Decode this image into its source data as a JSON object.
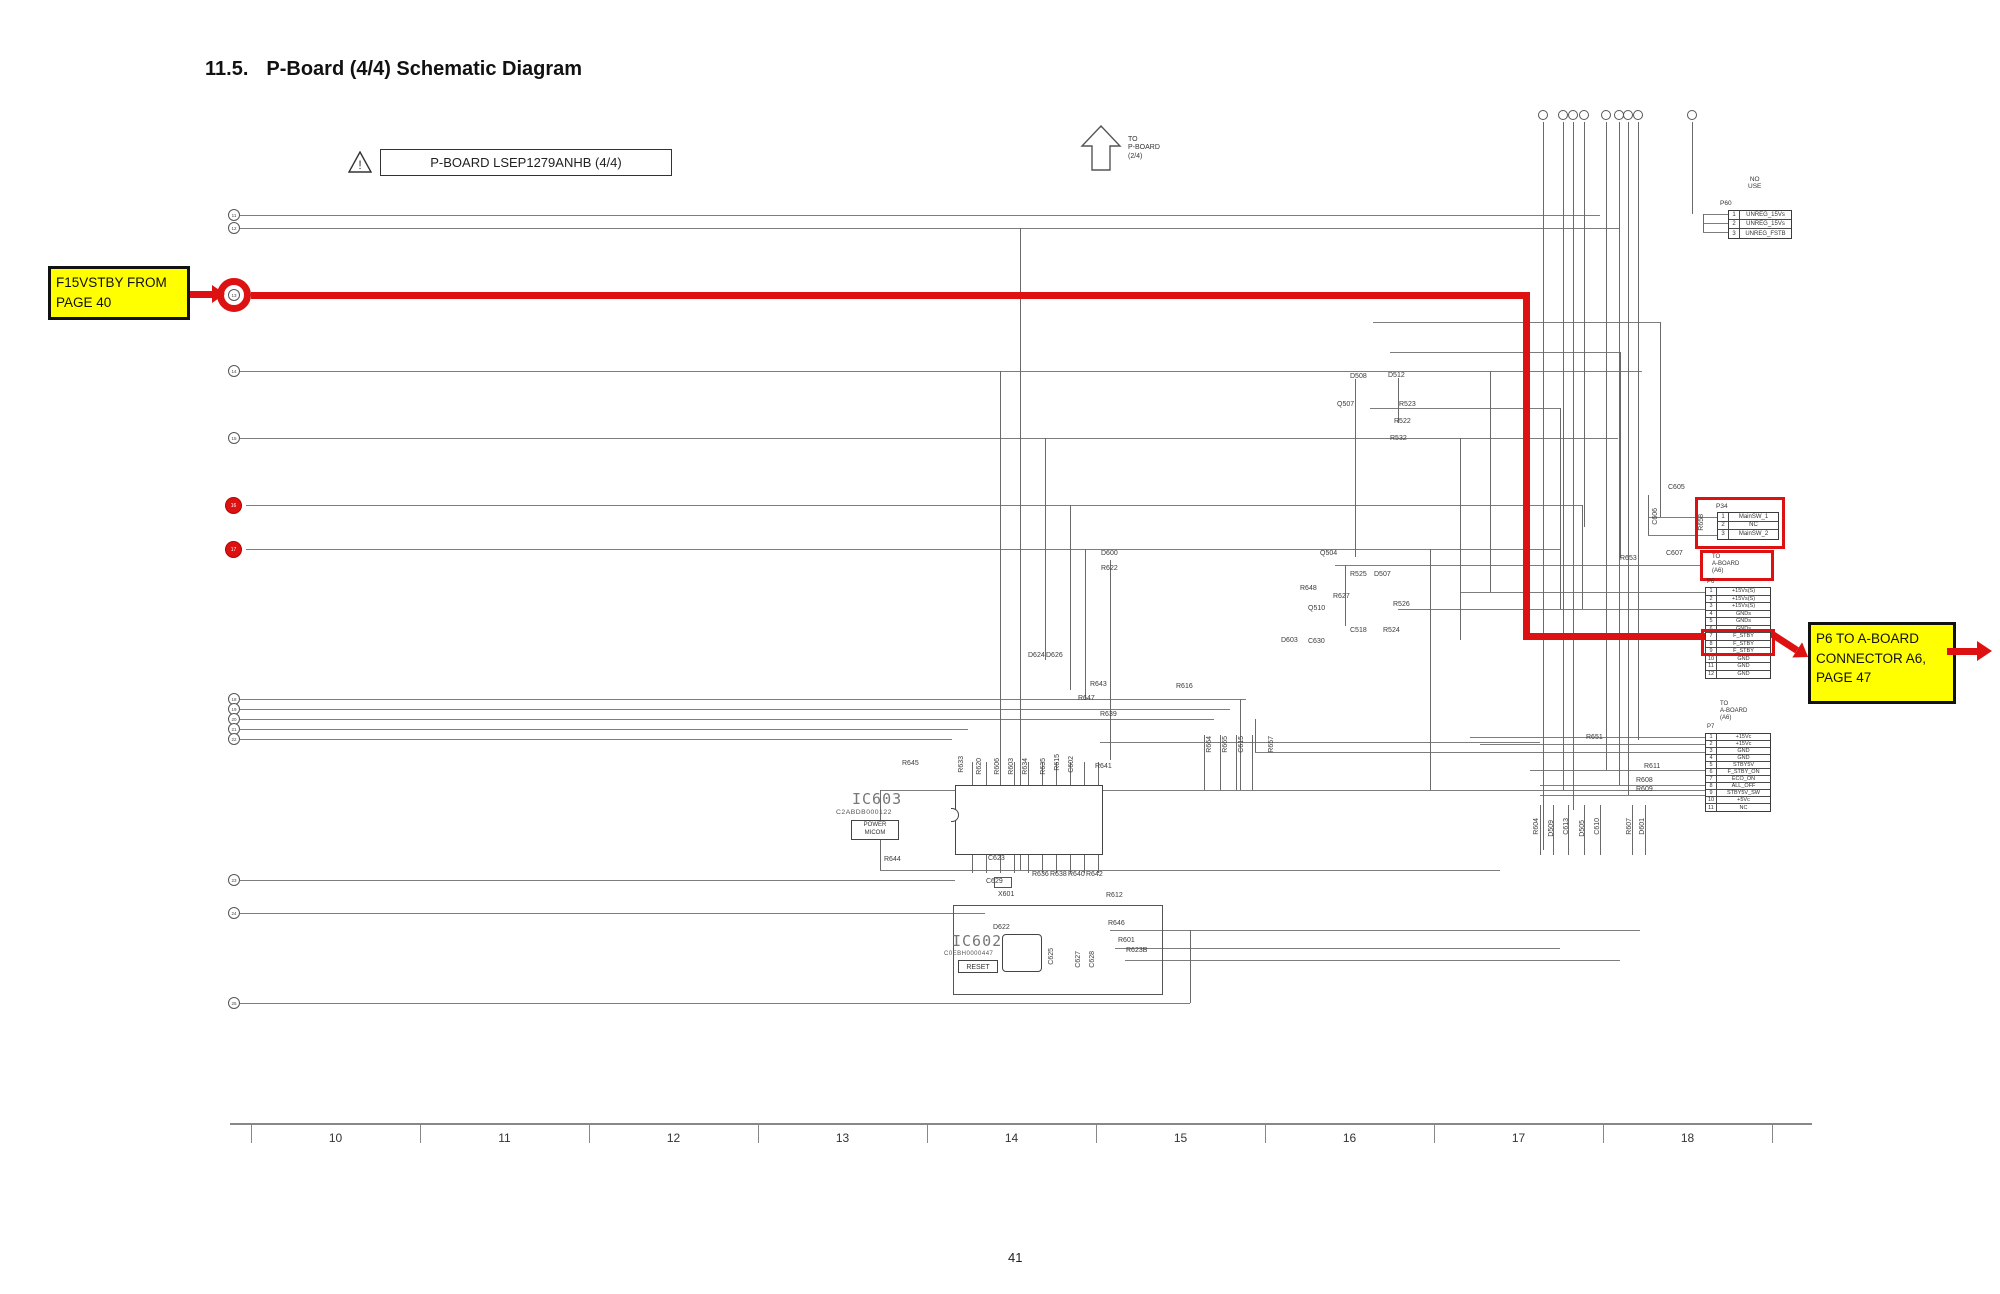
{
  "page": {
    "section_number": "11.5.",
    "section_title": "P-Board (4/4) Schematic Diagram",
    "page_number": "41"
  },
  "board_label": {
    "text": "P-BOARD LSEP1279ANHB (4/4)"
  },
  "to_pboard": {
    "line1": "TO",
    "line2": "P-BOARD",
    "line3": "(2/4)"
  },
  "callout_left": {
    "line1": "F15VSTBY FROM",
    "line2": "PAGE 40"
  },
  "callout_right": {
    "line1": "P6 TO A-BOARD",
    "line2": "CONNECTOR A6,",
    "line3": "PAGE 47"
  },
  "no_use": {
    "line1": "NO",
    "line2": "USE"
  },
  "colors": {
    "highlight_red": "#dd1111",
    "callout_yellow": "#ffff00",
    "wire_gray": "#7d7d7d"
  },
  "connectors": {
    "p60": {
      "name": "P60",
      "rows": [
        [
          "1",
          "UNREG_15Vs"
        ],
        [
          "2",
          "UNREG_15Vs"
        ],
        [
          "3",
          "UNREG_FSTB"
        ]
      ]
    },
    "p34": {
      "name": "P34",
      "rows": [
        [
          "1",
          "MainSW_1"
        ],
        [
          "2",
          "NC"
        ],
        [
          "3",
          "MainSW_2"
        ]
      ]
    },
    "p6": {
      "name": "P6",
      "dest_line1": "TO",
      "dest_line2": "A-BOARD",
      "dest_line3": "(A6)",
      "rows": [
        [
          "1",
          "+15Vs(S)"
        ],
        [
          "2",
          "+15Vs(S)"
        ],
        [
          "3",
          "+15Vs(S)"
        ],
        [
          "4",
          "GNDs"
        ],
        [
          "5",
          "GNDs"
        ],
        [
          "6",
          "GNDs"
        ],
        [
          "7",
          "F_STBY"
        ],
        [
          "8",
          "F_STBY"
        ],
        [
          "9",
          "F_STBY"
        ],
        [
          "10",
          "GND"
        ],
        [
          "11",
          "GND"
        ],
        [
          "12",
          "GND"
        ]
      ],
      "highlighted_rows": [
        "7",
        "8",
        "9"
      ]
    },
    "p7": {
      "name": "P7",
      "dest_line1": "TO",
      "dest_line2": "A-BOARD",
      "dest_line3": "(A6)",
      "rows": [
        [
          "1",
          "+15Vc"
        ],
        [
          "2",
          "+15Vc"
        ],
        [
          "3",
          "GND"
        ],
        [
          "4",
          "GND"
        ],
        [
          "5",
          "STBY5V"
        ],
        [
          "6",
          "F_STBY_ON"
        ],
        [
          "7",
          "ECO_ON"
        ],
        [
          "8",
          "ALL_OFF"
        ],
        [
          "9",
          "STBY5V_SW"
        ],
        [
          "10",
          "+5Vc"
        ],
        [
          "11",
          "NC"
        ]
      ]
    }
  },
  "ics": {
    "ic603": {
      "ref": "IC603",
      "part": "C2ABDB000122",
      "function_line1": "POWER",
      "function_line2": "MICOM",
      "top_pin_numbers": [
        "20",
        "19",
        "18",
        "17",
        "16",
        "15",
        "14",
        "13",
        "12",
        "11"
      ],
      "bottom_pin_numbers": [
        "1",
        "2",
        "3",
        "4",
        "5",
        "6",
        "7",
        "8",
        "9",
        "10"
      ],
      "top_pin_labels": [
        "AC_DET_L",
        "AC_FAIL_H",
        "P_RLY_ON_H",
        "N_RLY_ON_H",
        "F15_ON_H",
        "SOS4_H",
        "PFC_ON_L",
        "STB5_GD_H",
        "VF150_ON_L",
        "ALL_OFF_P"
      ],
      "bottom_pin_labels": [
        "VDD",
        "VSS",
        "Xin",
        "Xout",
        "CNVss",
        "RST_L",
        "M_SW_ON_H",
        "STB5_ON_L",
        "F-STB_ON_H",
        "PANEL_ON_L"
      ]
    },
    "ic602": {
      "ref": "IC602",
      "part": "C0EBH0000447",
      "function": "RESET",
      "pin_numbers_top": [
        "3",
        "2",
        "1"
      ],
      "pin_numbers_bottom": [
        "4",
        "5"
      ],
      "crystal": "X601"
    }
  },
  "ruler": {
    "labels": [
      "10",
      "11",
      "12",
      "13",
      "14",
      "15",
      "16",
      "17",
      "18"
    ]
  },
  "left_refs": [
    {
      "n": "11",
      "y": 215,
      "style": "plain"
    },
    {
      "n": "12",
      "y": 228,
      "style": "plain"
    },
    {
      "n": "13",
      "y": 295,
      "style": "red-ring"
    },
    {
      "n": "14",
      "y": 371,
      "style": "plain"
    },
    {
      "n": "15",
      "y": 438,
      "style": "plain"
    },
    {
      "n": "16",
      "y": 505,
      "style": "red-dot"
    },
    {
      "n": "17",
      "y": 549,
      "style": "red-dot"
    },
    {
      "n": "18",
      "y": 699,
      "style": "plain"
    },
    {
      "n": "19",
      "y": 709,
      "style": "plain"
    },
    {
      "n": "20",
      "y": 719,
      "style": "plain"
    },
    {
      "n": "21",
      "y": 729,
      "style": "plain"
    },
    {
      "n": "22",
      "y": 739,
      "style": "plain"
    },
    {
      "n": "23",
      "y": 880,
      "style": "plain"
    },
    {
      "n": "24",
      "y": 913,
      "style": "plain"
    },
    {
      "n": "25",
      "y": 1003,
      "style": "plain"
    }
  ],
  "components": [
    {
      "l": "R645",
      "x": 902,
      "y": 760,
      "r": 0
    },
    {
      "l": "R633",
      "x": 958,
      "y": 756,
      "r": 1
    },
    {
      "l": "R620",
      "x": 976,
      "y": 758,
      "r": 1
    },
    {
      "l": "R606",
      "x": 994,
      "y": 758,
      "r": 1
    },
    {
      "l": "R603",
      "x": 1008,
      "y": 758,
      "r": 1
    },
    {
      "l": "R634",
      "x": 1022,
      "y": 758,
      "r": 1
    },
    {
      "l": "R635",
      "x": 1040,
      "y": 758,
      "r": 1
    },
    {
      "l": "R615",
      "x": 1054,
      "y": 754,
      "r": 1
    },
    {
      "l": "C602",
      "x": 1068,
      "y": 756,
      "r": 1
    },
    {
      "l": "R641",
      "x": 1095,
      "y": 763,
      "r": 0
    },
    {
      "l": "R644",
      "x": 884,
      "y": 856,
      "r": 0
    },
    {
      "l": "C623",
      "x": 988,
      "y": 855,
      "r": 0
    },
    {
      "l": "C629",
      "x": 986,
      "y": 878,
      "r": 0
    },
    {
      "l": "R613",
      "x": 1012,
      "y": 850,
      "r": 0
    },
    {
      "l": "R636",
      "x": 1032,
      "y": 871,
      "r": 0
    },
    {
      "l": "R638",
      "x": 1050,
      "y": 871,
      "r": 0
    },
    {
      "l": "R640",
      "x": 1068,
      "y": 871,
      "r": 0
    },
    {
      "l": "R642",
      "x": 1086,
      "y": 871,
      "r": 0
    },
    {
      "l": "D622",
      "x": 993,
      "y": 924,
      "r": 0
    },
    {
      "l": "R612",
      "x": 1106,
      "y": 892,
      "r": 0
    },
    {
      "l": "R646",
      "x": 1108,
      "y": 920,
      "r": 0
    },
    {
      "l": "R601",
      "x": 1118,
      "y": 937,
      "r": 0
    },
    {
      "l": "R623B",
      "x": 1126,
      "y": 947,
      "r": 0
    },
    {
      "l": "C625",
      "x": 1048,
      "y": 948,
      "r": 1
    },
    {
      "l": "C627",
      "x": 1075,
      "y": 951,
      "r": 1
    },
    {
      "l": "C628",
      "x": 1089,
      "y": 951,
      "r": 1
    },
    {
      "l": "D624",
      "x": 1028,
      "y": 652,
      "r": 0
    },
    {
      "l": "D626",
      "x": 1046,
      "y": 652,
      "r": 0
    },
    {
      "l": "R643",
      "x": 1090,
      "y": 681,
      "r": 0
    },
    {
      "l": "R647",
      "x": 1078,
      "y": 695,
      "r": 0
    },
    {
      "l": "R639",
      "x": 1100,
      "y": 711,
      "r": 0
    },
    {
      "l": "R616",
      "x": 1176,
      "y": 683,
      "r": 0
    },
    {
      "l": "D600",
      "x": 1101,
      "y": 550,
      "r": 0
    },
    {
      "l": "R622",
      "x": 1101,
      "y": 565,
      "r": 0
    },
    {
      "l": "D508",
      "x": 1350,
      "y": 373,
      "r": 0
    },
    {
      "l": "D512",
      "x": 1388,
      "y": 372,
      "r": 0
    },
    {
      "l": "Q507",
      "x": 1337,
      "y": 401,
      "r": 0
    },
    {
      "l": "R523",
      "x": 1399,
      "y": 401,
      "r": 0
    },
    {
      "l": "R522",
      "x": 1394,
      "y": 418,
      "r": 0
    },
    {
      "l": "R532",
      "x": 1390,
      "y": 435,
      "r": 0
    },
    {
      "l": "Q504",
      "x": 1320,
      "y": 550,
      "r": 0
    },
    {
      "l": "R525",
      "x": 1350,
      "y": 571,
      "r": 0
    },
    {
      "l": "D507",
      "x": 1374,
      "y": 571,
      "r": 0
    },
    {
      "l": "R648",
      "x": 1300,
      "y": 585,
      "r": 0
    },
    {
      "l": "R627",
      "x": 1333,
      "y": 593,
      "r": 0
    },
    {
      "l": "Q510",
      "x": 1308,
      "y": 605,
      "r": 0
    },
    {
      "l": "R526",
      "x": 1393,
      "y": 601,
      "r": 0
    },
    {
      "l": "C518",
      "x": 1350,
      "y": 627,
      "r": 0
    },
    {
      "l": "R524",
      "x": 1383,
      "y": 627,
      "r": 0
    },
    {
      "l": "D603",
      "x": 1281,
      "y": 637,
      "r": 0
    },
    {
      "l": "C630",
      "x": 1308,
      "y": 638,
      "r": 0
    },
    {
      "l": "C605",
      "x": 1668,
      "y": 484,
      "r": 0
    },
    {
      "l": "C606",
      "x": 1652,
      "y": 508,
      "r": 1
    },
    {
      "l": "C607",
      "x": 1666,
      "y": 550,
      "r": 0
    },
    {
      "l": "R653",
      "x": 1620,
      "y": 555,
      "r": 0
    },
    {
      "l": "R658",
      "x": 1698,
      "y": 514,
      "r": 1
    },
    {
      "l": "R664",
      "x": 1206,
      "y": 736,
      "r": 1
    },
    {
      "l": "R665",
      "x": 1222,
      "y": 736,
      "r": 1
    },
    {
      "l": "C615",
      "x": 1238,
      "y": 736,
      "r": 1
    },
    {
      "l": "R657",
      "x": 1268,
      "y": 736,
      "r": 1
    },
    {
      "l": "R604",
      "x": 1533,
      "y": 818,
      "r": 1
    },
    {
      "l": "D509",
      "x": 1548,
      "y": 820,
      "r": 1
    },
    {
      "l": "C613",
      "x": 1563,
      "y": 818,
      "r": 1
    },
    {
      "l": "D505",
      "x": 1579,
      "y": 820,
      "r": 1
    },
    {
      "l": "C610",
      "x": 1594,
      "y": 818,
      "r": 1
    },
    {
      "l": "R607",
      "x": 1626,
      "y": 818,
      "r": 1
    },
    {
      "l": "D601",
      "x": 1639,
      "y": 818,
      "r": 1
    },
    {
      "l": "R611",
      "x": 1644,
      "y": 763,
      "r": 0
    },
    {
      "l": "R608",
      "x": 1636,
      "y": 777,
      "r": 0
    },
    {
      "l": "R609",
      "x": 1636,
      "y": 786,
      "r": 0
    },
    {
      "l": "R651",
      "x": 1586,
      "y": 734,
      "r": 0
    }
  ]
}
